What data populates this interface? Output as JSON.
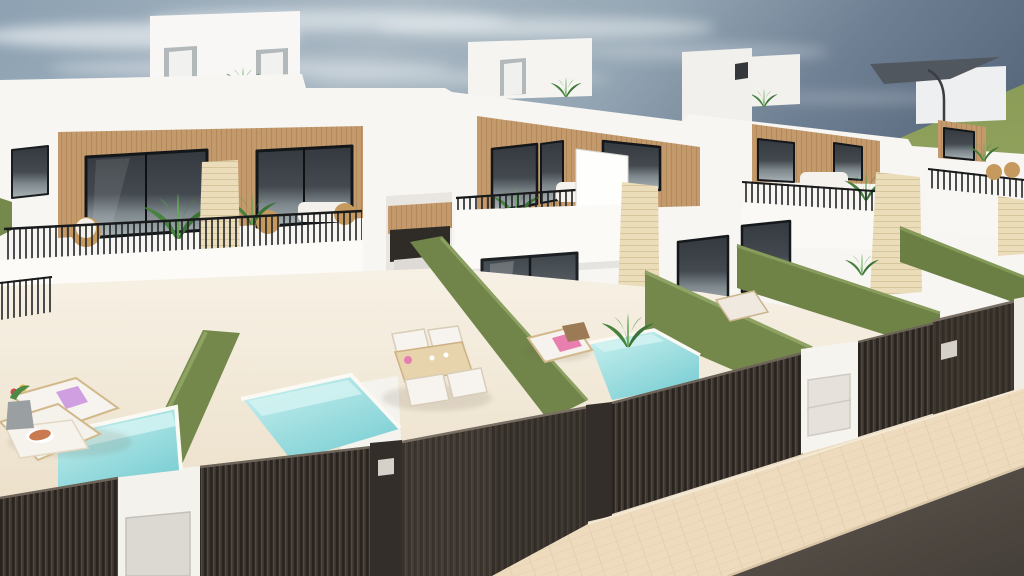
{
  "scene": {
    "title": "New-build white villas with private pools – 3D architectural render",
    "type": "3d-render",
    "description": "Aerial three-quarter view of a row of modern two-storey white villas with roof terraces, wood-slat facades, black railings, green grass-covered dividing walls, turquoise plunge pools, dark slatted street fences and gates, beige sidewalk and asphalt road under a hazy blue sky",
    "layers": {
      "sky": "hazy blue sky with wispy clouds, darker slate at top right",
      "field": "green field on the right horizon",
      "buildings": "row of four white villas with roof-access boxes, wood-slat window bands, balconies and travertine pillars",
      "ground": "cream terrace and yard flooring",
      "hedges": "olive artificial-grass dividing walls between yards",
      "pools": "three turquoise plunge pools",
      "furniture": "sun loungers, dining set, potted palms, parasol",
      "fences": "dark brown slatted street fences, gates and white letterbox pillars",
      "street": "beige paved sidewalk and dark asphalt road"
    },
    "counts": {
      "villas": 4,
      "pools": 3,
      "roof_boxes": 5,
      "street_gates": 3,
      "sun_loungers": 4
    },
    "palette": {
      "sky_top_left": "#8da1b2",
      "sky_top_right": "#5a6a7e",
      "sky_haze": "#d6dde0",
      "cloud": "#e9eef1",
      "field_green": "#8a9c57",
      "wall_white": "#f7f6f3",
      "wall_shadow": "#e6e4e0",
      "wood_slat": "#c49a6c",
      "stone_pillar": "#ebdcba",
      "window_dark": "#33393e",
      "glass_reflection": "#c7cfd0",
      "railing_black": "#202224",
      "hedge_green": "#74884b",
      "hedge_light": "#8da263",
      "pool_light": "#cdf2f0",
      "pool_deep": "#7ccfd4",
      "fence_dark": "#3d362f",
      "gate_dark": "#4a433c",
      "pillar_white": "#f4f2ed",
      "pavement": "#eedbbe",
      "road": "#575049",
      "lounger_white": "#f7f4ef",
      "towel_pink": "#e087c0",
      "table_wood": "#e7d4ad"
    }
  }
}
